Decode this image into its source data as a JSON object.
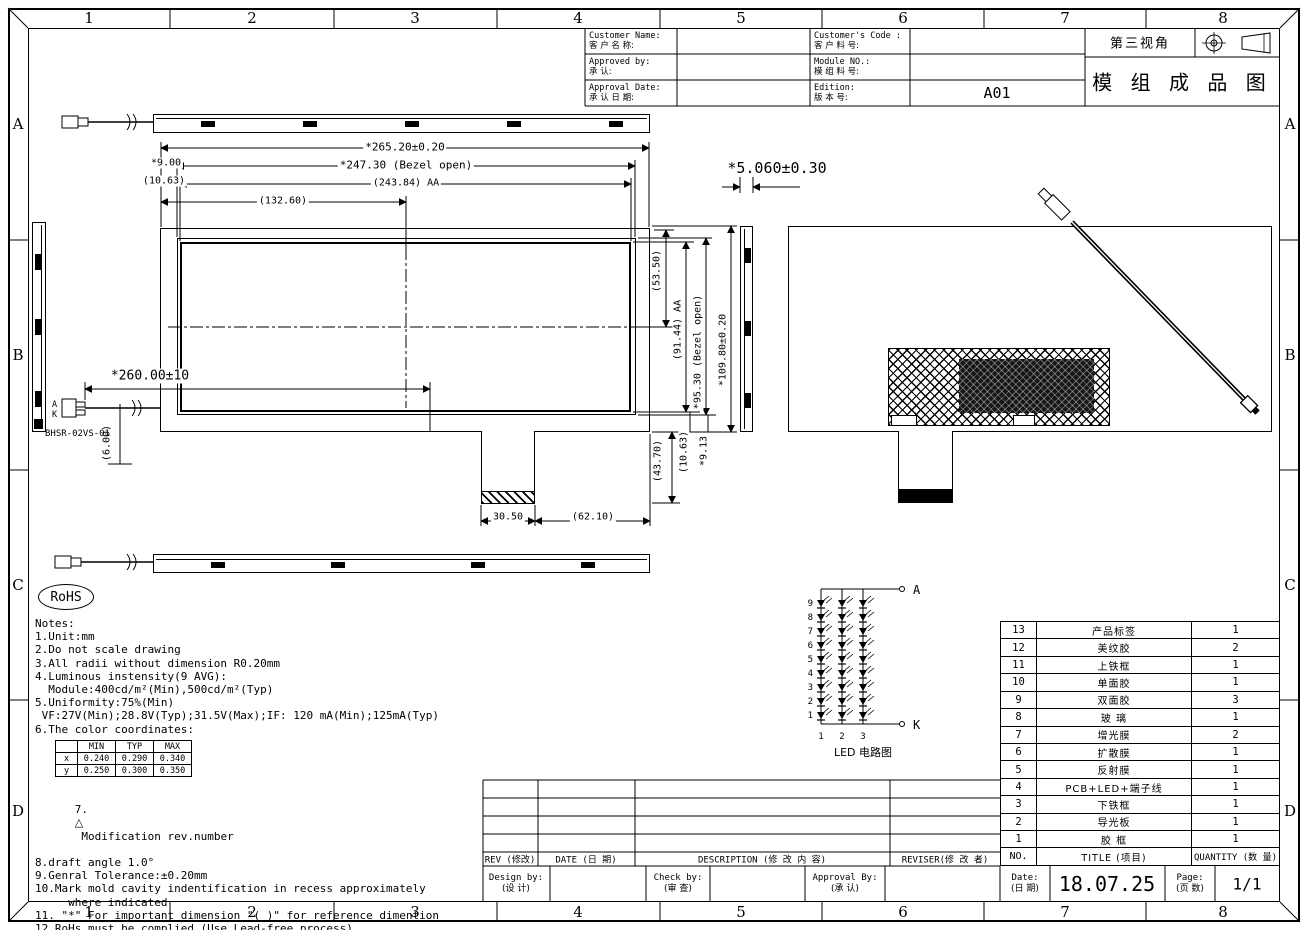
{
  "sheet": {
    "grid_cols": [
      "1",
      "2",
      "3",
      "4",
      "5",
      "6",
      "7",
      "8"
    ],
    "grid_rows": [
      "A",
      "B",
      "C",
      "D"
    ]
  },
  "title_block": {
    "customer_name_en": "Customer Name:",
    "customer_name_cn": "客 户 名 称:",
    "approved_by_en": "Approved by:",
    "approved_by_cn": "承  认:",
    "approval_date_en": "Approval Date:",
    "approval_date_cn": "承 认 日 期:",
    "customers_code_en": "Customer's Code :",
    "customers_code_cn": "客 户 料 号:",
    "module_no_en": "Module  NO.:",
    "module_no_cn": "模 组 料 号:",
    "edition_en": "Edition:",
    "edition_cn": "版 本 号:",
    "edition_value": "A01",
    "third_angle": "第三视角",
    "drawing_title": "模 组 成 品 图"
  },
  "dimensions": {
    "overall_width": "*265.20±0.20",
    "bezel_width": "*247.30 (Bezel open)",
    "aa_width": "(243.84) AA",
    "half_width": "(132.60)",
    "left_offset": "*9.00",
    "left_offset2": "(10.63)",
    "right_53": "(53.50)",
    "aa_height": "(91.44) AA",
    "bezel_height": "*95.30 (Bezel open)",
    "overall_height": "*109.80±0.20",
    "lower_43": "(43.70)",
    "lower_10": "(10.63)",
    "lower_9": "*9.13",
    "tab_width": "30.50",
    "tab_offset": "(62.10)",
    "cable_length": "*260.00±10",
    "cable_offset": "(6.00)",
    "thickness": "*5.060±0.30",
    "connector_model": "BHSR-02VS-01",
    "anode": "A",
    "cathode": "K"
  },
  "rohs": "RoHS",
  "icons": {
    "revision_triangle": "△"
  },
  "notes": {
    "heading": "Notes:",
    "lines1": [
      "1.Unit:mm",
      "2.Do not scale drawing",
      "3.All radii without dimension R0.20mm",
      "4.Luminous instensity(9 AVG):",
      "  Module:400cd/m²(Min),500cd/m²(Typ)",
      "5.Uniformity:75%(Min)",
      " VF:27V(Min);28.8V(Typ);31.5V(Max);IF: 120 mA(Min);125mA(Typ)",
      "6.The color coordinates:"
    ],
    "line7_prefix": "7.",
    "line7_text": " Modification rev.number",
    "lines2": [
      "8.draft angle 1.0°",
      "9.Genral Tolerance:±0.20mm",
      "10.Mark mold cavity indentification in recess approximately",
      "     where indicated",
      "11. \"*\" For important dimension \"( )\" for reference dimention",
      "12.RoHs must be complied.(Use Lead-free process)"
    ]
  },
  "color_table": {
    "headers": [
      "",
      "MIN",
      "TYP",
      "MAX"
    ],
    "rows": [
      {
        "label": "x",
        "min": "0.240",
        "typ": "0.290",
        "max": "0.340"
      },
      {
        "label": "y",
        "min": "0.250",
        "typ": "0.300",
        "max": "0.350"
      }
    ]
  },
  "led_circuit": {
    "row_labels": [
      "9",
      "8",
      "7",
      "6",
      "5",
      "4",
      "3",
      "2",
      "1"
    ],
    "col_labels": [
      "1",
      "2",
      "3"
    ],
    "anode": "A",
    "cathode": "K",
    "caption": "LED 电路图"
  },
  "bom": {
    "header": {
      "no": "NO.",
      "title": "TITLE (项目)",
      "qty": "QUANTITY (数 量)"
    },
    "rows": [
      {
        "no": "13",
        "title": "产品标签",
        "qty": "1"
      },
      {
        "no": "12",
        "title": "美纹胶",
        "qty": "2"
      },
      {
        "no": "11",
        "title": "上铁框",
        "qty": "1"
      },
      {
        "no": "10",
        "title": "单面胶",
        "qty": "1"
      },
      {
        "no": "9",
        "title": "双面胶",
        "qty": "3"
      },
      {
        "no": "8",
        "title": "玻 璃",
        "qty": "1"
      },
      {
        "no": "7",
        "title": "增光膜",
        "qty": "2"
      },
      {
        "no": "6",
        "title": "扩散膜",
        "qty": "1"
      },
      {
        "no": "5",
        "title": "反射膜",
        "qty": "1"
      },
      {
        "no": "4",
        "title": "PCB+LED+端子线",
        "qty": "1"
      },
      {
        "no": "3",
        "title": "下铁框",
        "qty": "1"
      },
      {
        "no": "2",
        "title": "导光板",
        "qty": "1"
      },
      {
        "no": "1",
        "title": "胶 框",
        "qty": "1"
      }
    ]
  },
  "revision_table": {
    "rev": "REV (修改)",
    "date": "DATE (日 期)",
    "description": "DESCRIPTION (修 改 内 容)",
    "reviser": "REVISER(修 改 者)"
  },
  "signature": {
    "design_en": "Design by:",
    "design_cn": "(设 计)",
    "check_en": "Check by:",
    "check_cn": "(审 查)",
    "approval_en": "Approval By:",
    "approval_cn": "(承 认)",
    "date_en": "Date:",
    "date_cn": "(日 期)",
    "date_value": "18.07.25",
    "page_en": "Page:",
    "page_cn": "(页 数)",
    "page_value": "1/1"
  }
}
